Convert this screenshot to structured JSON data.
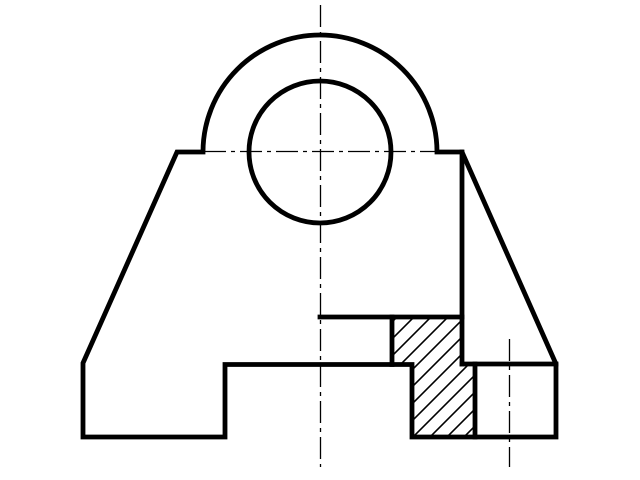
{
  "canvas": {
    "width": 640,
    "height": 480,
    "background": "#ffffff",
    "line_color": "#000000",
    "thick_stroke": 4.8,
    "thin_stroke": 1.3,
    "hatch_stroke": 1.6,
    "centerline_dash": "22 5 4 5"
  },
  "drawing": {
    "outline_path": "M 83 437 L 83 363 L 177 152 L 203 152 A 117 117 0 0 1 437 152 L 462 152 L 556 364 L 556 437 L 412 437 L 412 364.5 L 225 364.5 L 225 437 L 83 437 Z",
    "bore_circle": {
      "cx": 320,
      "cy": 152,
      "r": 71
    },
    "internal_edges": [
      {
        "name": "section-step-top-edge",
        "path": "M 320 317 L 462 317"
      },
      {
        "name": "hatch-left-edge",
        "path": "M 392 317 L 392 364.5"
      },
      {
        "name": "section-cut-vertical-edge",
        "path": "M 462 152 L 462 364"
      },
      {
        "name": "right-block-top-edge",
        "path": "M 462 364 L 556 364"
      },
      {
        "name": "hatch-foot-right-edge",
        "path": "M 475 364 L 475 437"
      }
    ],
    "section_hatch_region": "M 392 317 L 462 317 L 462 364 L 475 364 L 475 437 L 412 437 L 412 364.5 L 392 364.5 Z",
    "hatch": {
      "angle_deg": 45,
      "spacing": 17
    },
    "centerlines": [
      {
        "name": "vertical-center-axis",
        "x1": 320.5,
        "y1": 5,
        "x2": 320.5,
        "y2": 467
      },
      {
        "name": "horizontal-center-axis",
        "x1": 204,
        "y1": 151.5,
        "x2": 437,
        "y2": 151.5
      },
      {
        "name": "right-hole-center-axis",
        "x1": 509.5,
        "y1": 339,
        "x2": 509.5,
        "y2": 467
      }
    ]
  }
}
